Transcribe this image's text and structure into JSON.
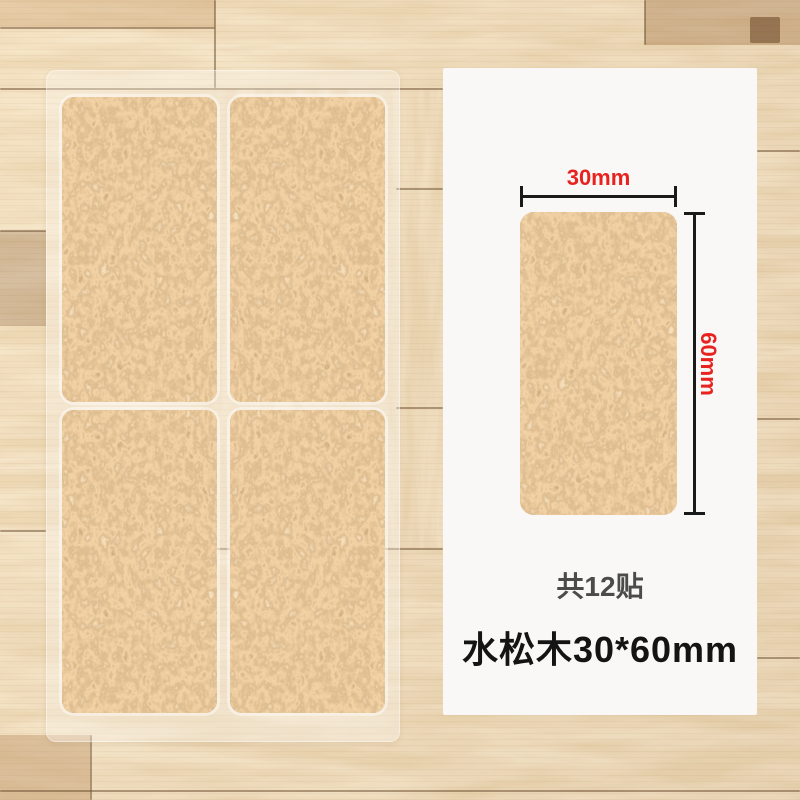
{
  "scene": {
    "description": "cork furniture pad product photo on wood floor",
    "floor_base_color": "#dcbc8e"
  },
  "sticker_sheet": {
    "pad_count_visible": 4,
    "pad_texture": "cork",
    "cork_base_color": "#d2a066"
  },
  "info_panel": {
    "bg_color": "#f9f8f6",
    "accent_red": "#e8231f",
    "dimension_line_color": "#1a1a1a",
    "width_label": "30mm",
    "height_label": "60mm",
    "count_text": "共12贴",
    "product_title": "水松木30*60mm",
    "count_text_color": "#4b4b4b",
    "title_color": "#141414"
  }
}
